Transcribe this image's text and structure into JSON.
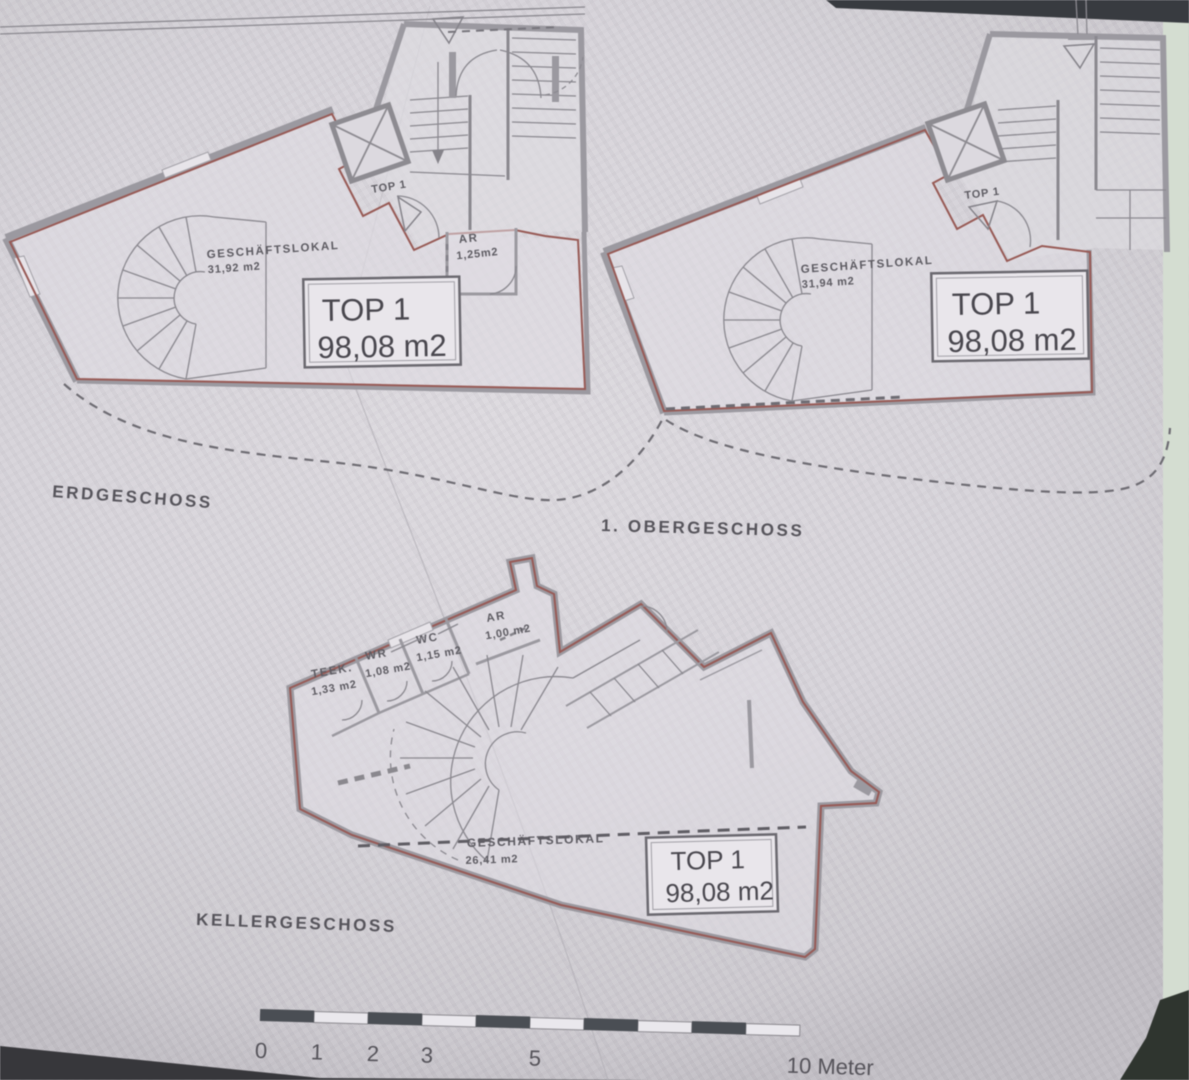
{
  "plans": [
    {
      "floor_label": "ERDGESCHOSS",
      "unit_door_label": "TOP 1",
      "unit_box": {
        "title": "TOP 1",
        "area": "98,08 m2"
      },
      "rooms": [
        {
          "name": "GESCHÄFTSLOKAL",
          "area": "31,92 m2"
        },
        {
          "name": "AR",
          "area": "1,25m2"
        }
      ]
    },
    {
      "floor_label": "1. OBERGESCHOSS",
      "unit_door_label": "TOP 1",
      "unit_box": {
        "title": "TOP 1",
        "area": "98,08 m2"
      },
      "rooms": [
        {
          "name": "GESCHÄFTSLOKAL",
          "area": "31,94 m2"
        }
      ]
    },
    {
      "floor_label": "KELLERGESCHOSS",
      "unit_box": {
        "title": "TOP 1",
        "area": "98,08 m2"
      },
      "rooms": [
        {
          "name": "TEEK.",
          "area": "1,33 m2"
        },
        {
          "name": "WR",
          "area": "1,08 m2"
        },
        {
          "name": "WC",
          "area": "1,15 m2"
        },
        {
          "name": "AR",
          "area": "1,00 m2"
        },
        {
          "name": "GESCHÄFTSLOKAL",
          "area": "26,41 m2"
        }
      ]
    }
  ],
  "scale_bar": {
    "tick_labels": [
      "0",
      "1",
      "2",
      "3",
      "5"
    ],
    "end_label": "10 Meter"
  },
  "colors": {
    "unit_outline": "#9a5a55",
    "wall": "#9b99a0",
    "ink": "#54525a",
    "paper": "#d5d2d8"
  }
}
